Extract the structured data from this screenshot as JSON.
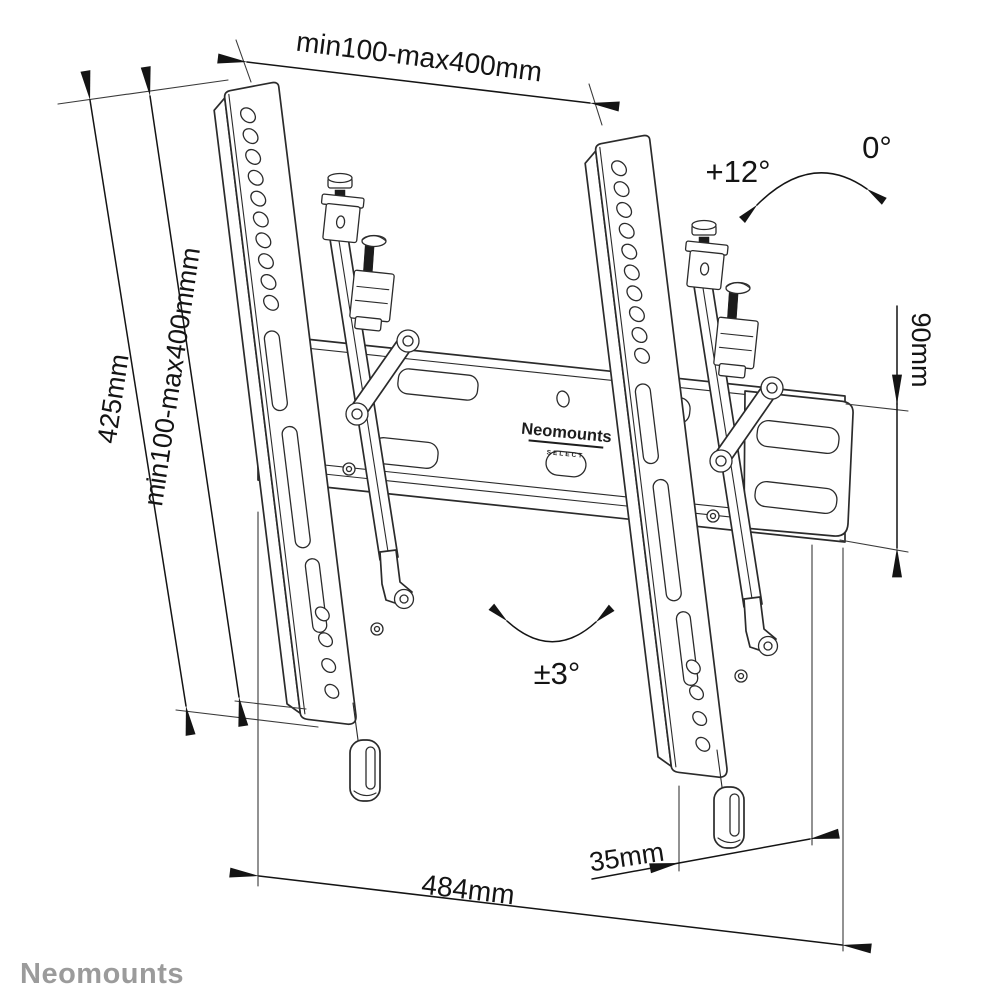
{
  "dimensions": {
    "top_width": "min100-max400mm",
    "left_height": "425mm",
    "left_vesa_height": "min100-max400mmm",
    "plate_height": "90mm",
    "tilt_positive": "+12°",
    "tilt_zero": "0°",
    "swivel": "±3°",
    "offset_depth": "35mm",
    "plate_width": "484mm"
  },
  "product": {
    "label_brand": "Neomounts",
    "label_sub": "SELECT"
  },
  "brand": {
    "logo_text": "Neomounts"
  },
  "style": {
    "line_color": "#2b2b2b",
    "dim_color": "#141414",
    "brand_gray": "#9b9b9b",
    "background": "#ffffff"
  }
}
